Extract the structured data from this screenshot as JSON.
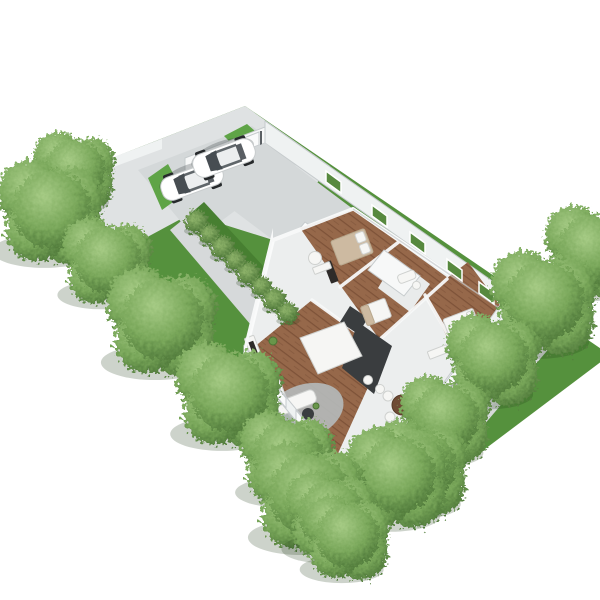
{
  "scene": {
    "description": "Aerial 3D render of a single-story house floor plan on a long landscaped lot, white background, rows of round green trees along both sides, two white cars on the driveway at top, wooden deck and patio dining set at the bottom",
    "background": "#ffffff"
  },
  "palette": {
    "bg": "#ffffff",
    "grass": "#55913d",
    "grass_bright": "#5fa447",
    "grass_shade": "#477f31",
    "tree_light": "#a6cb85",
    "tree_mid": "#79a75a",
    "tree_dark": "#466f33",
    "bush_light": "#8fb46b",
    "bush_dark": "#3d682c",
    "concrete": "#dfe2e3",
    "concrete_dark": "#d6d9da",
    "driveway": "#d4d8d9",
    "wall": "#eff2f2",
    "wall_bright": "#f7f8f8",
    "wall_edge": "#c6cbcd",
    "floor_base": "#eceeee",
    "floor_wood": "#96684a",
    "floor_wood_dark": "#7d5238",
    "tile": "#e9ebeb",
    "counter_dark": "#3a3d3f",
    "furniture_white": "#f6f6f4",
    "furniture_stroke": "#cfd1cf",
    "bed_beige": "#cdbaa1",
    "rug": "#b4b8b9",
    "deck_wood": "#d0bfae",
    "deck_line": "#b9a48f",
    "deck_rail": "#7c4f37",
    "table_brown": "#6f4b35",
    "car_body": "#ffffff",
    "car_glass": "#474d52",
    "car_wheel": "#26292b",
    "window_green": "#57893f"
  },
  "lot": {
    "trees_left_row": 8,
    "trees_right_row": 7,
    "hedge_bushes": 8,
    "rooms": [
      "garage",
      "bedroom-1",
      "bedroom-2",
      "bathroom",
      "kitchen",
      "living-room",
      "bedroom-3"
    ],
    "outdoor_areas": [
      "driveway",
      "front-walkway",
      "patio",
      "deck",
      "backyard"
    ]
  },
  "cars": {
    "count": 2,
    "body_color": "#ffffff"
  },
  "furniture": {
    "beds": 3,
    "sofa": 1,
    "rug": 1,
    "outdoor_dining_chairs": 4,
    "outdoor_dining_table": 1,
    "deck_planter": 1
  }
}
